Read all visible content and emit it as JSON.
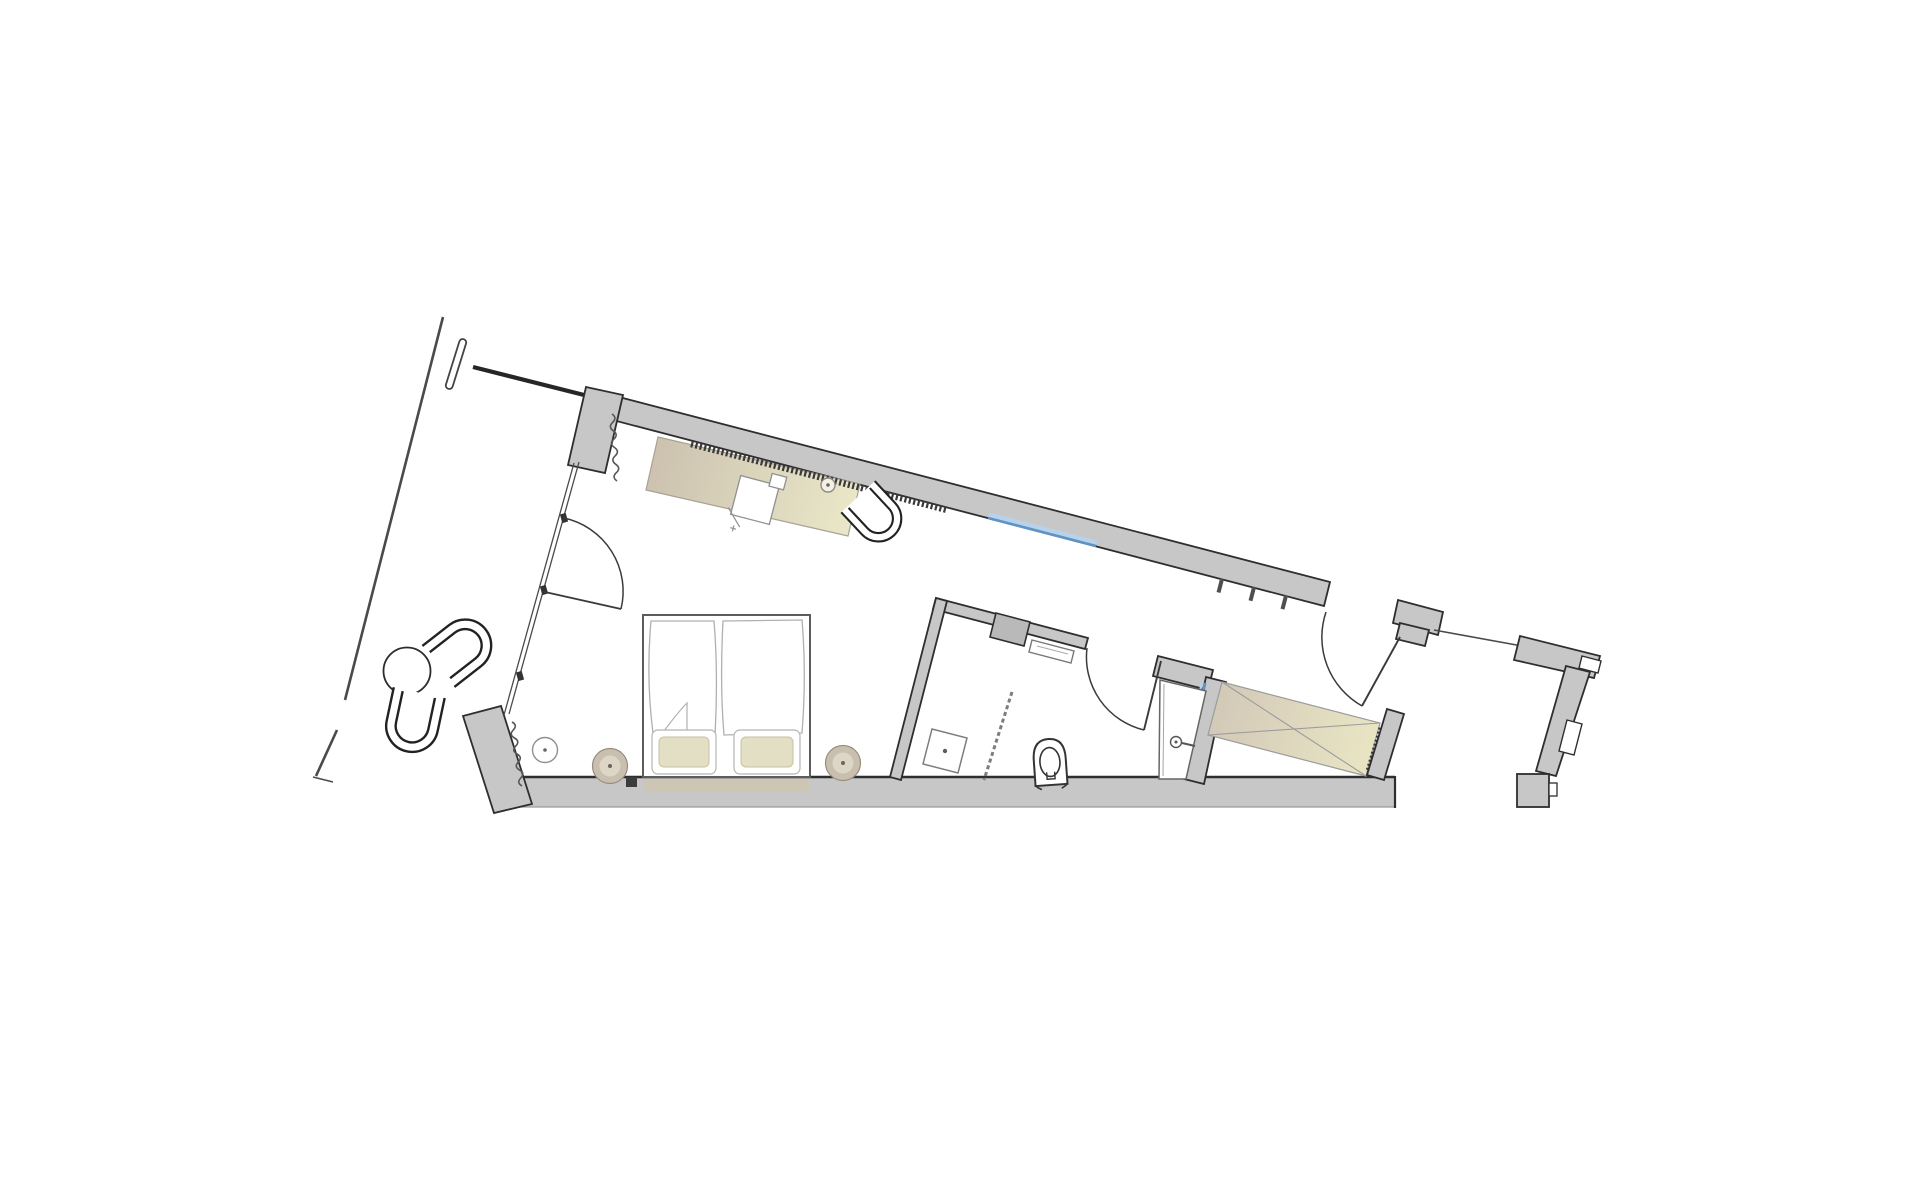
{
  "document": {
    "kind": "architectural floor plan",
    "style": "line drawing, rotated hotel-room suite plan on white background",
    "visible_text": [],
    "orientation_deg_of_top_wall": 14.6
  },
  "colors": {
    "background": "#ffffff",
    "wall_fill": "#c7c7c7",
    "wall_fill_dark": "#b9b9b9",
    "wall_stroke": "#2e2e2e",
    "line_dark": "#4a4a4a",
    "line_door": "#3a3a3a",
    "line_mid": "#4a4a4a",
    "line_light": "#b0b0b0",
    "teeth_hatch": "#3a3a3a",
    "chair_stroke": "#222222",
    "desk_beige_dark": "#ccc2af",
    "desk_beige_light": "#eae7c8",
    "wardrobe_beige_dark": "#d3c9b8",
    "wardrobe_beige_light": "#e9e5c3",
    "pillow_fill": "#e2dfc5",
    "pillow_stroke": "#c6c2a4",
    "stool_tan_fill": "#c9bfae",
    "stool_tan_inner": "#ddd5c6",
    "glazing_blue": "#5f93c4",
    "glazing_blue_light": "#b7d2ea",
    "underbed_strip": "#cfc6b2"
  },
  "rooms": [
    {
      "name": "balcony",
      "contents": [
        "lounge-chair",
        "lounge-chair",
        "round-table"
      ]
    },
    {
      "name": "bedroom",
      "contents": [
        "double-bed",
        "pillows",
        "duvets",
        "bedside-stool",
        "bedside-stool",
        "side-table",
        "desk",
        "desk-chair",
        "desk-lamp",
        "armchair",
        "curtain",
        "curtain"
      ]
    },
    {
      "name": "bathroom",
      "contents": [
        "shower",
        "shower-glass-partition",
        "toilet",
        "vanity-counter",
        "washbasin",
        "wall-shelf",
        "tiled-wall"
      ]
    },
    {
      "name": "entry",
      "contents": [
        "entry-door",
        "coat-hooks",
        "threshold-line"
      ]
    },
    {
      "name": "wardrobe-niche",
      "contents": [
        "wardrobe-crossed-box"
      ]
    },
    {
      "name": "adjacent-structure",
      "contents": [
        "corridor-wall-fragment",
        "service-niche"
      ]
    }
  ],
  "openings": {
    "entry_door": "top wall right, swings inward toward wardrobe",
    "bathroom_door": "bathroom top wall, swings into bathroom",
    "balcony_door": "glazed wall left, swings into bedroom",
    "window": "top wall, blue glazing segment",
    "glazed_balcony_wall": "double thin line with three mullion blocks"
  }
}
